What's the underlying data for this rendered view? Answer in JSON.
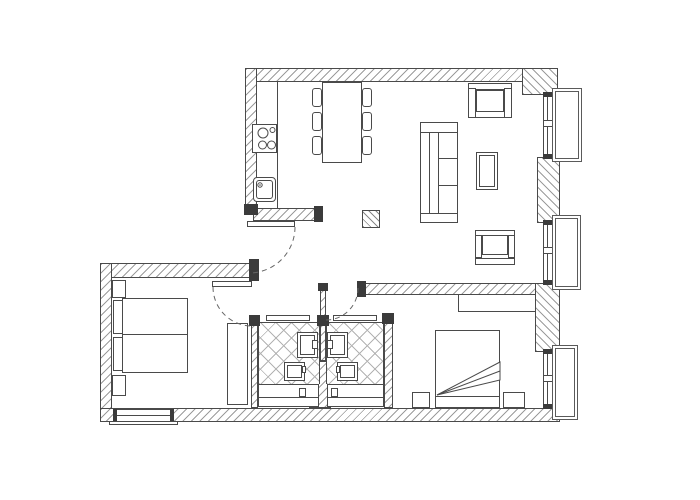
{
  "title": "Apartment floor plan (black and white architectural drawing)",
  "colors": {
    "background": "#ffffff",
    "line": "#4a4a4a",
    "wall_hatch": "#9c9c9c",
    "tile_lines": "#b3b3b3",
    "jamb_cap": "#3b3b3b"
  },
  "rooms": {
    "kitchen": "Kitchen",
    "living_room": "Living room",
    "hallway": "Entry hallway",
    "bedroom_left": "Bedroom (left)",
    "bedroom_right": "Bedroom (right)",
    "bathroom_left": "Bathroom (left)",
    "bathroom_right": "Bathroom (right)"
  },
  "furniture": {
    "counter": "Kitchen counter",
    "stove": "Cooktop with 4 burners",
    "sink": "Kitchen sink",
    "dining_table": "Dining table with 6 chairs",
    "stool": "Hatched side table",
    "sofa": "Three-seat sofa",
    "armchair_top": "Armchair (top)",
    "armchair_bottom": "Armchair (bottom)",
    "coffee_table": "Coffee table",
    "bed_left": "Double bed with pillows and nightstands",
    "wardrobe_left": "Wardrobe",
    "bed_right": "Double bed with folded duvet",
    "wardrobe_right": "Wardrobe shelf",
    "nightstand": "Nightstand",
    "washbasin": "Washbasin",
    "toilet": "Toilet",
    "bathtub": "Bathtub",
    "sliding_door": "Bathroom sliding door",
    "entry_door": "Entry door",
    "bedroom_door": "Bedroom door",
    "window": "Window with exterior sill"
  }
}
